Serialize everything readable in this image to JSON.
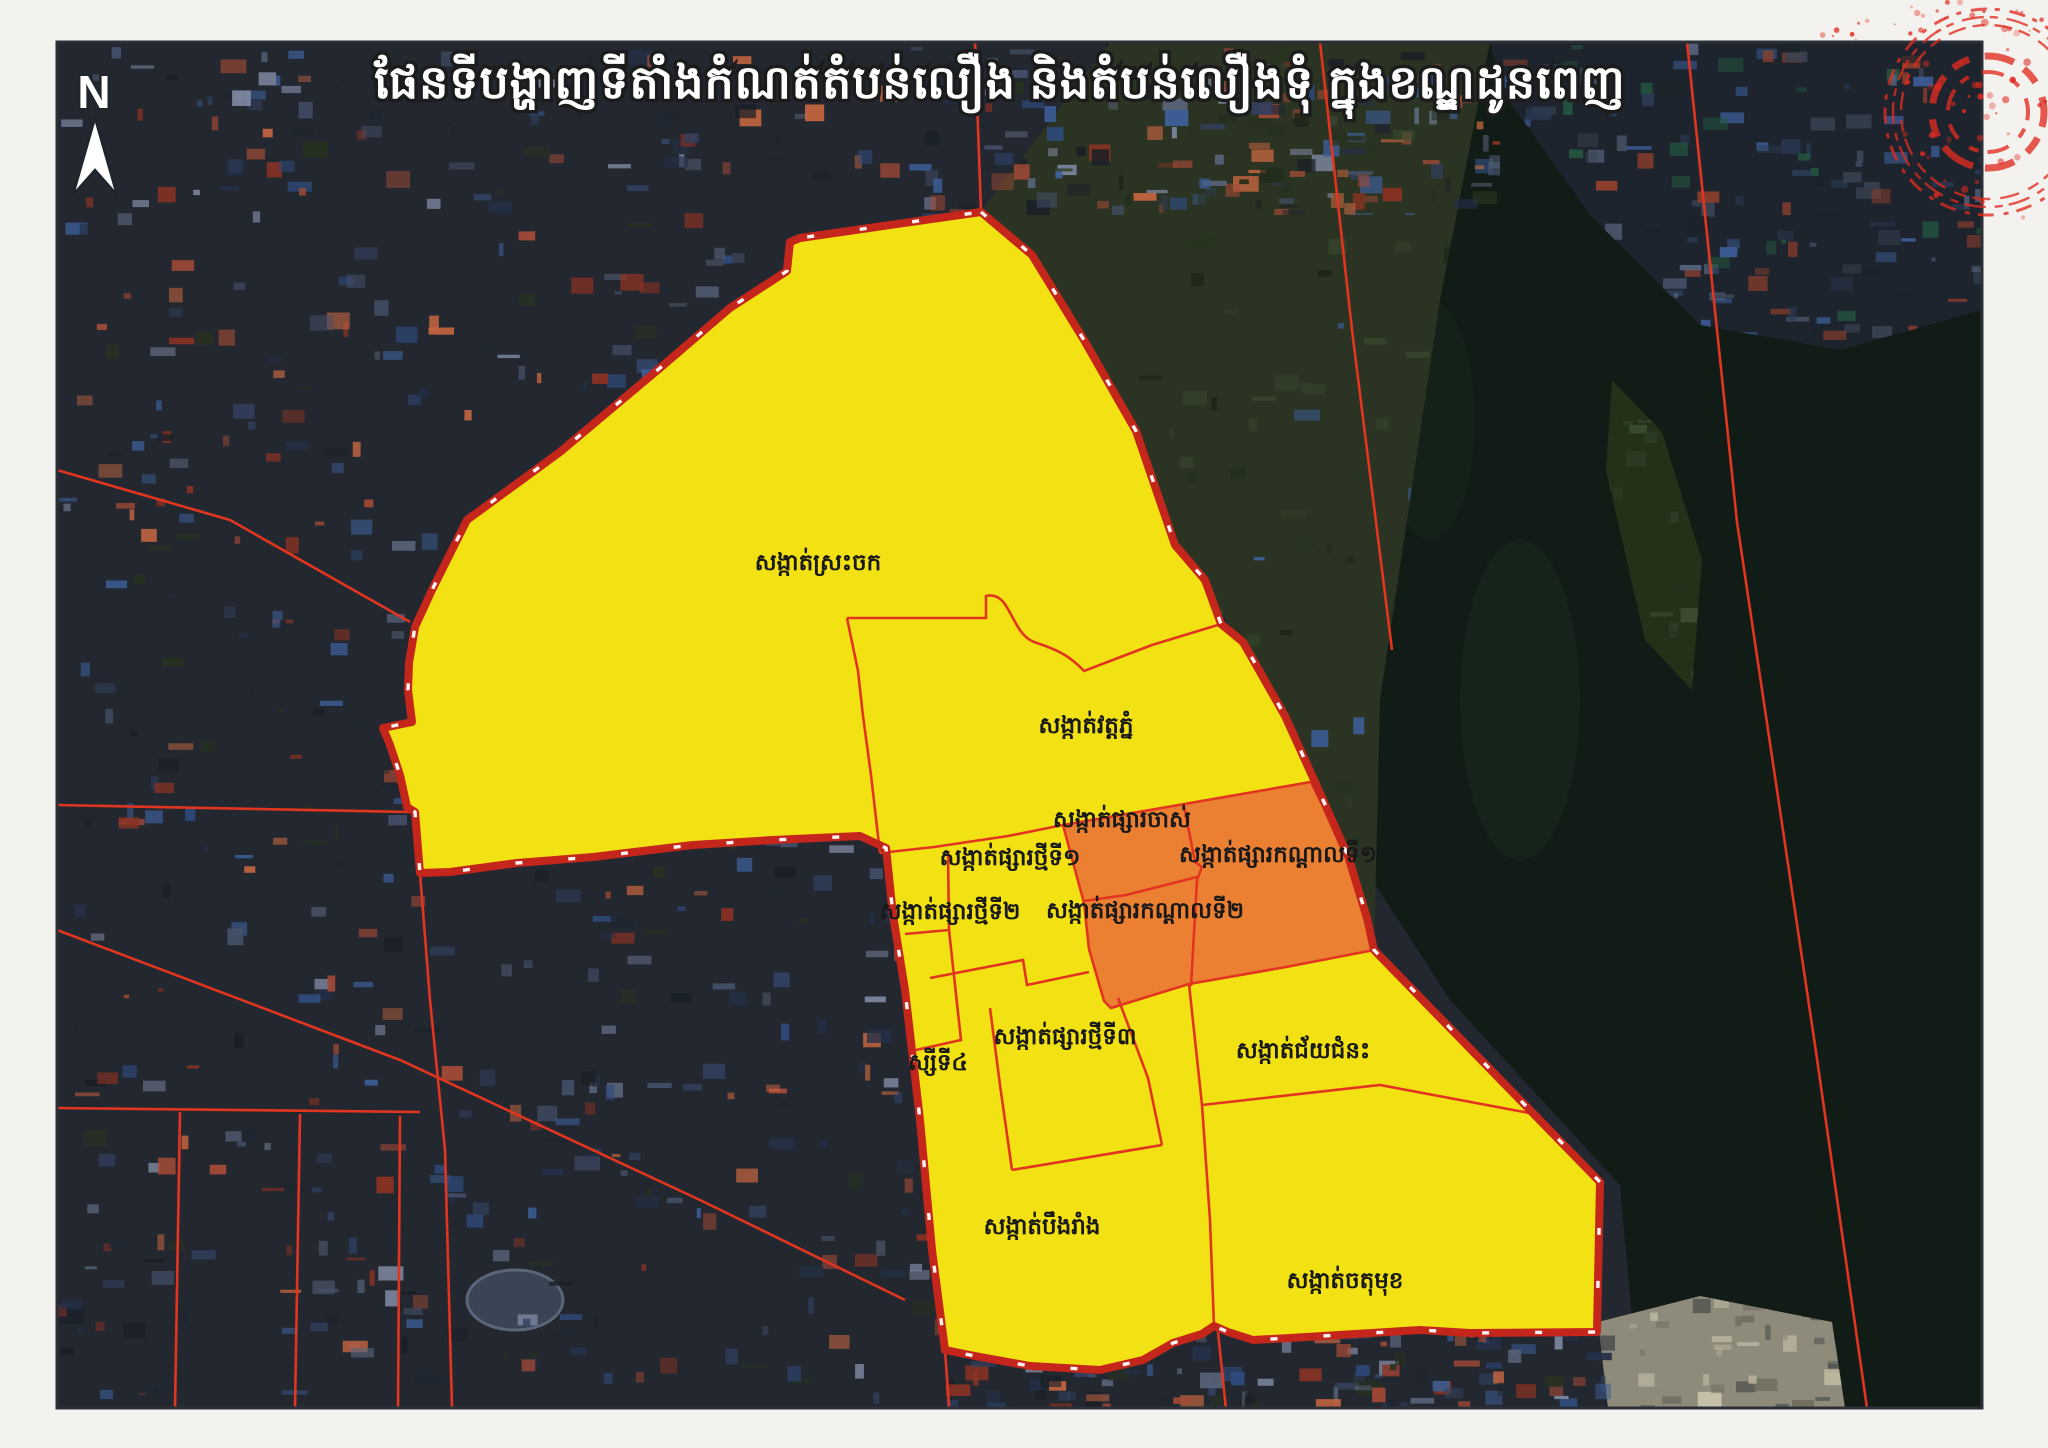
{
  "page": {
    "margin_color": "#f3f2ee",
    "frame_color": "#2b2f37"
  },
  "title": {
    "text": "ផែនទីបង្ហាញទីតាំងកំណត់តំបន់លឿង និងតំបន់លឿងទុំ ក្នុងខណ្ឌដូនពេញ",
    "color": "#ffffff",
    "outline_color": "#1c1c1c"
  },
  "compass": {
    "label": "N"
  },
  "zones": {
    "yellow_zone_color": "#f2e113",
    "orange_zone_color": "#ec8032",
    "boundary_color": "#c4261b",
    "inner_line_color": "#e23520",
    "tick_color": "#ffffff"
  },
  "labels": [
    {
      "text": "សង្កាត់ស្រះចក",
      "x": 818,
      "y": 570
    },
    {
      "text": "សង្កាត់វត្តភ្នំ",
      "x": 1086,
      "y": 733
    },
    {
      "text": "សង្កាត់ផ្សារចាស់",
      "x": 1122,
      "y": 827
    },
    {
      "text": "សង្កាត់ផ្សារកណ្ដាលទី១",
      "x": 1278,
      "y": 862
    },
    {
      "text": "សង្កាត់ផ្សារថ្មីទី១",
      "x": 1010,
      "y": 865
    },
    {
      "text": "សង្កាត់ផ្សារថ្មីទី២",
      "x": 950,
      "y": 919
    },
    {
      "text": "សង្កាត់ផ្សារកណ្ដាលទី២",
      "x": 1145,
      "y": 918
    },
    {
      "text": "សង្កាត់ផ្សារថ្មីទី៣",
      "x": 1065,
      "y": 1044
    },
    {
      "text": "ស្សីទី៤",
      "x": 938,
      "y": 1070
    },
    {
      "text": "សង្កាត់ជ័យជំនះ",
      "x": 1303,
      "y": 1058
    },
    {
      "text": "សង្កាត់បឹងរាំង",
      "x": 1042,
      "y": 1234
    },
    {
      "text": "សង្កាត់ចតុមុខ",
      "x": 1345,
      "y": 1288
    }
  ],
  "stamp": {
    "color": "#e02a20"
  }
}
